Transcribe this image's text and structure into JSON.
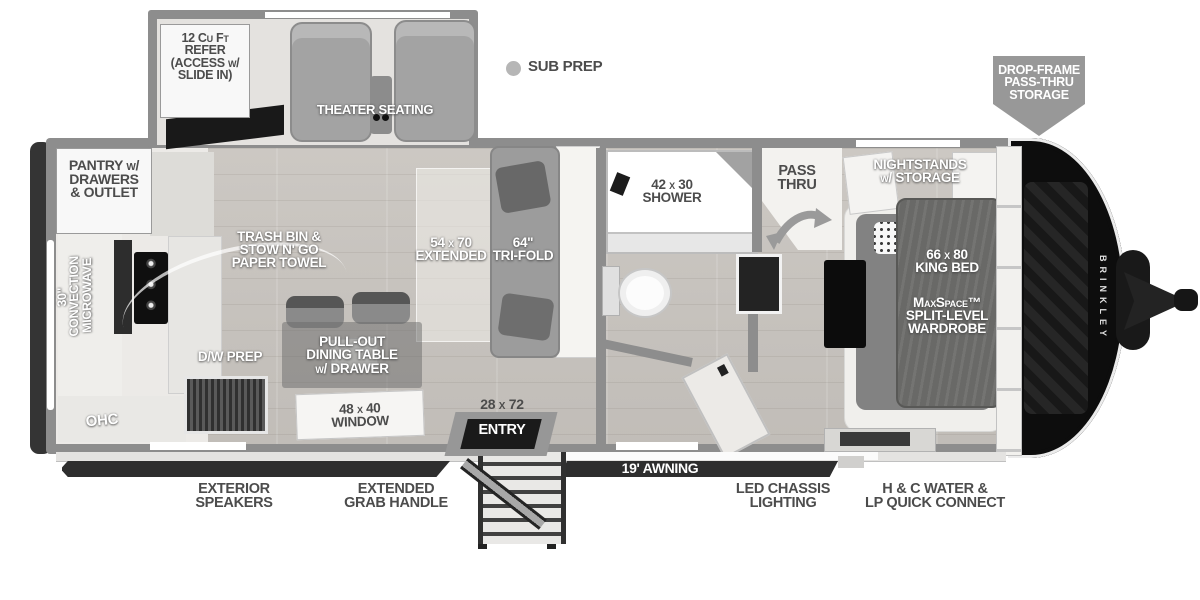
{
  "legend": {
    "sub_prep": "SUB PREP"
  },
  "slideout": {
    "refer": "12 Cu Ft\nREFER\n(ACCESS w/\nSLIDE IN)",
    "theater": "THEATER SEATING"
  },
  "kitchen": {
    "pantry": "PANTRY w/\nDRAWERS\n& OUTLET",
    "microwave": "30\" CONVECTION\nMICROWAVE",
    "trash": "TRASH BIN &\nSTOW N' GO\nPAPER TOWEL",
    "dw_prep": "D/W PREP",
    "ohc": "OHC",
    "dining_table": "PULL-OUT\nDINING TABLE\nw/ DRAWER",
    "window": "48 x 40\nWINDOW"
  },
  "living": {
    "extended": "54 x 70\nEXTENDED",
    "tri_fold": "64\"\nTRI-FOLD",
    "entry_size": "28 x 72",
    "entry": "ENTRY"
  },
  "bathroom": {
    "shower": "42 x 30\nSHOWER",
    "pass_thru": "PASS\nTHRU"
  },
  "bedroom": {
    "nightstands": "NIGHTSTANDS\nw/ STORAGE",
    "king_bed": "66 x 80\nKING BED",
    "wardrobe": "MaxSpace™\nSPLIT-LEVEL\nWARDROBE"
  },
  "exterior": {
    "drop_frame": "DROP-FRAME\nPASS-THRU\nSTORAGE",
    "awning": "19' AWNING",
    "speakers": "EXTERIOR\nSPEAKERS",
    "grab_handle": "EXTENDED\nGRAB HANDLE",
    "led_chassis": "LED CHASSIS\nLIGHTING",
    "water_connect": "H & C WATER &\nLP QUICK CONNECT",
    "brand": "BRINKLEY"
  },
  "colors": {
    "wall": "#8d8d8d",
    "floor": "#c7c3be",
    "chassis_dark": "#2e2e2e",
    "label_dark": "#4c4c4c",
    "label_light": "#ffffff",
    "badge": "#989898"
  }
}
